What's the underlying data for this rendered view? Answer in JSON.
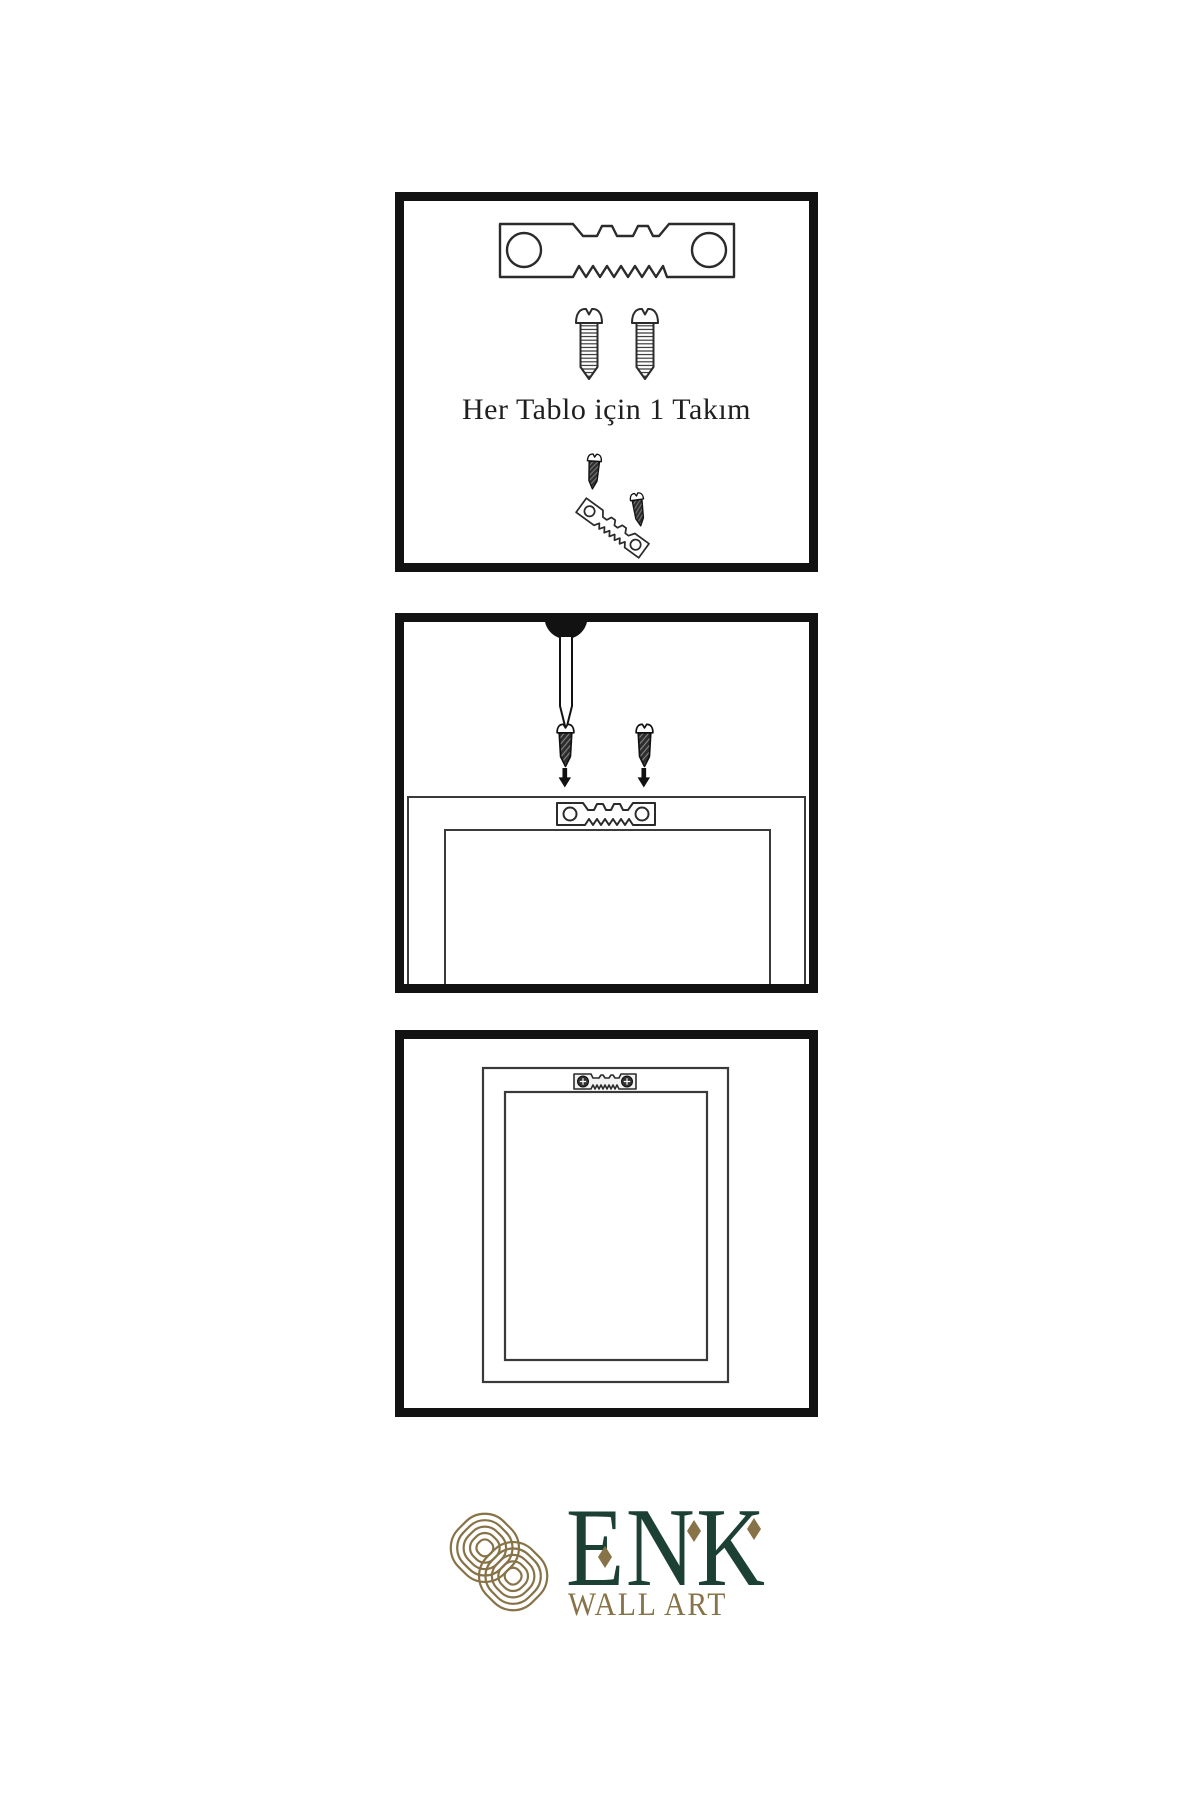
{
  "colors": {
    "background": "#ffffff",
    "line": "#2b2b2b",
    "panel_border": "#121212",
    "logo_gold": "#877347",
    "logo_green": "#1d4035"
  },
  "steps": [
    {
      "name": "kit-contents",
      "caption": "Her Tablo için 1 Takım",
      "icons": [
        "sawtooth-hanger-icon",
        "screw-icon",
        "screw-icon",
        "screw-into-hanger-icon"
      ]
    },
    {
      "name": "attach-hanger-to-frame",
      "icons": [
        "wall-nail-icon",
        "dark-screw-icon",
        "dark-screw-icon",
        "down-arrow-icon",
        "down-arrow-icon",
        "frame-back-icon",
        "sawtooth-hanger-icon"
      ]
    },
    {
      "name": "hang-frame-on-wall",
      "icons": [
        "frame-front-icon",
        "mounted-hanger-icon"
      ]
    }
  ],
  "logo": {
    "brand": "ENK",
    "subtitle": "WALL ART",
    "icon": "knot-icon"
  }
}
